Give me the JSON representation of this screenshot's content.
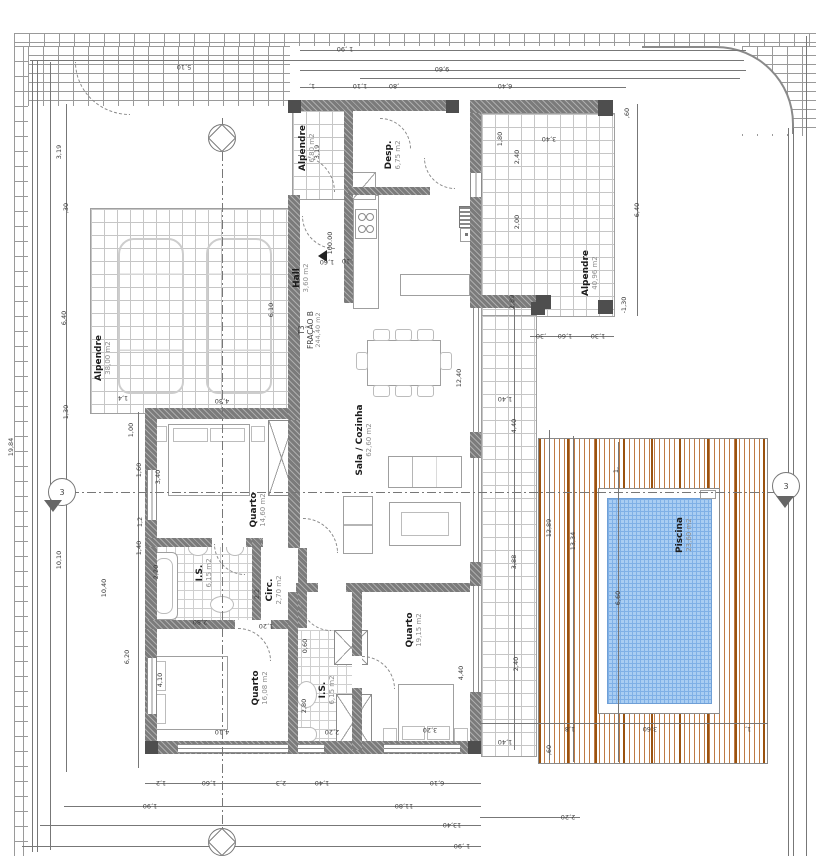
{
  "plan": {
    "fraction": {
      "line1": "T3",
      "line2": "FRAÇÃO B",
      "line3": "244,40 m2"
    },
    "level_marker": "100.00",
    "section_label": "3",
    "rooms": [
      {
        "name": "Alpendre",
        "area": "38,00 m2"
      },
      {
        "name": "Alpendre",
        "area": "6,80 m2"
      },
      {
        "name": "Hall",
        "area": "3,60 m2"
      },
      {
        "name": "Desp.",
        "area": "6,75 m2"
      },
      {
        "name": "Sala / Cozinha",
        "area": "62,60 m2"
      },
      {
        "name": "Quarto",
        "area": "14,60 m2"
      },
      {
        "name": "I.S.",
        "area": "6,15 m2"
      },
      {
        "name": "Circ.",
        "area": "2,70 m2"
      },
      {
        "name": "Quarto",
        "area": "16,08 m2"
      },
      {
        "name": "I.S.",
        "area": "6,15 m2"
      },
      {
        "name": "Quarto",
        "area": "19,15 m2"
      },
      {
        "name": "Alpendre",
        "area": "40,96 m2"
      },
      {
        "name": "Piscina",
        "area": "23,60 m2"
      }
    ],
    "dim_labels": [
      {
        "t": "1 ,90",
        "x": 345,
        "y": 49,
        "r": 180
      },
      {
        "t": "9,60",
        "x": 442,
        "y": 69,
        "r": 180
      },
      {
        "t": "5,10",
        "x": 184,
        "y": 67,
        "r": 180
      },
      {
        "t": "1,",
        "x": 312,
        "y": 86,
        "r": 180
      },
      {
        "t": "1,10",
        "x": 360,
        "y": 86,
        "r": 180
      },
      {
        "t": ",80",
        "x": 394,
        "y": 86,
        "r": 180
      },
      {
        "t": "6,40",
        "x": 505,
        "y": 86,
        "r": 180
      },
      {
        "t": ",60",
        "x": 627,
        "y": 113,
        "r": -90
      },
      {
        "t": "3,40",
        "x": 549,
        "y": 139,
        "r": 180
      },
      {
        "t": "2,40",
        "x": 517,
        "y": 157,
        "r": -90
      },
      {
        "t": "2,00",
        "x": 517,
        "y": 222,
        "r": -90
      },
      {
        "t": "6,40",
        "x": 637,
        "y": 210,
        "r": -90
      },
      {
        "t": "-1,30",
        "x": 624,
        "y": 305,
        "r": -90
      },
      {
        "t": "2,89",
        "x": 512,
        "y": 302,
        "r": -90
      },
      {
        "t": ",30",
        "x": 541,
        "y": 336,
        "r": 180
      },
      {
        "t": "1,60",
        "x": 565,
        "y": 336,
        "r": 180
      },
      {
        "t": "1,30",
        "x": 598,
        "y": 336,
        "r": 180
      },
      {
        "t": "1,40",
        "x": 505,
        "y": 399,
        "r": 180
      },
      {
        "t": "4,40",
        "x": 514,
        "y": 426,
        "r": -90
      },
      {
        "t": "3,88",
        "x": 514,
        "y": 562,
        "r": -90
      },
      {
        "t": "2,40",
        "x": 516,
        "y": 664,
        "r": -90
      },
      {
        "t": "1,40",
        "x": 505,
        "y": 742,
        "r": 180
      },
      {
        "t": "12,89",
        "x": 549,
        "y": 528,
        "r": -90
      },
      {
        "t": "13,34",
        "x": 573,
        "y": 541,
        "r": -90
      },
      {
        "t": "1,",
        "x": 616,
        "y": 470,
        "r": -90
      },
      {
        "t": "6,60",
        "x": 618,
        "y": 598,
        "r": -90
      },
      {
        "t": ",60",
        "x": 549,
        "y": 750,
        "r": -90
      },
      {
        "t": "1,8",
        "x": 570,
        "y": 729,
        "r": 180
      },
      {
        "t": "3,60",
        "x": 650,
        "y": 729,
        "r": 180
      },
      {
        "t": "1,",
        "x": 748,
        "y": 729,
        "r": 180
      },
      {
        "t": "2,20",
        "x": 568,
        "y": 817,
        "r": 180
      },
      {
        "t": "19,84",
        "x": 11,
        "y": 447,
        "r": -90
      },
      {
        "t": "3,19",
        "x": 59,
        "y": 152,
        "r": -90
      },
      {
        "t": ",30",
        "x": 66,
        "y": 208,
        "r": -90
      },
      {
        "t": "6,40",
        "x": 64,
        "y": 318,
        "r": -90
      },
      {
        "t": "1,30",
        "x": 66,
        "y": 412,
        "r": -90
      },
      {
        "t": "10,10",
        "x": 59,
        "y": 560,
        "r": -90
      },
      {
        "t": "1,00",
        "x": 131,
        "y": 430,
        "r": -90
      },
      {
        "t": "1,60",
        "x": 139,
        "y": 470,
        "r": -90
      },
      {
        "t": "1,2",
        "x": 140,
        "y": 522,
        "r": -90
      },
      {
        "t": "1,40",
        "x": 139,
        "y": 548,
        "r": -90
      },
      {
        "t": "10,40",
        "x": 104,
        "y": 588,
        "r": -90
      },
      {
        "t": "6,20",
        "x": 127,
        "y": 657,
        "r": -90
      },
      {
        "t": "6,10",
        "x": 271,
        "y": 310,
        "r": -90
      },
      {
        "t": "1,4",
        "x": 123,
        "y": 398,
        "r": 180
      },
      {
        "t": "4,30",
        "x": 222,
        "y": 401,
        "r": 180
      },
      {
        "t": "3,19",
        "x": 317,
        "y": 152,
        "r": -90
      },
      {
        "t": "1,60",
        "x": 327,
        "y": 262,
        "r": 180
      },
      {
        "t": ",10",
        "x": 347,
        "y": 261,
        "r": 180
      },
      {
        "t": "1,80",
        "x": 500,
        "y": 139,
        "r": -90
      },
      {
        "t": "12,40",
        "x": 459,
        "y": 378,
        "r": -90
      },
      {
        "t": "3,40",
        "x": 158,
        "y": 477,
        "r": -90
      },
      {
        "t": "2,80",
        "x": 200,
        "y": 622,
        "r": 180
      },
      {
        "t": "1,20",
        "x": 266,
        "y": 626,
        "r": 180
      },
      {
        "t": "2,20",
        "x": 156,
        "y": 572,
        "r": -90
      },
      {
        "t": "2,2",
        "x": 257,
        "y": 594,
        "r": -90
      },
      {
        "t": "0,60",
        "x": 305,
        "y": 646,
        "r": -90
      },
      {
        "t": "2,80",
        "x": 304,
        "y": 706,
        "r": -90
      },
      {
        "t": "4,10",
        "x": 160,
        "y": 680,
        "r": -90
      },
      {
        "t": "4,10",
        "x": 222,
        "y": 732,
        "r": 180
      },
      {
        "t": "2,20",
        "x": 332,
        "y": 732,
        "r": 180
      },
      {
        "t": "3,20",
        "x": 430,
        "y": 730,
        "r": 180
      },
      {
        "t": "4,40",
        "x": 461,
        "y": 673,
        "r": -90
      },
      {
        "t": "1,2",
        "x": 161,
        "y": 783,
        "r": 180
      },
      {
        "t": "1,60",
        "x": 209,
        "y": 783,
        "r": 180
      },
      {
        "t": "2,3",
        "x": 281,
        "y": 783,
        "r": 180
      },
      {
        "t": "1,40",
        "x": 322,
        "y": 783,
        "r": 180
      },
      {
        "t": "6,10",
        "x": 437,
        "y": 783,
        "r": 180
      },
      {
        "t": "1,90",
        "x": 150,
        "y": 806,
        "r": 180
      },
      {
        "t": "11,80",
        "x": 404,
        "y": 806,
        "r": 180
      },
      {
        "t": "13,40",
        "x": 452,
        "y": 825,
        "r": 180
      },
      {
        "t": "1 ,90",
        "x": 462,
        "y": 846,
        "r": 180
      }
    ],
    "colors": {
      "wall": "#7b7b7b",
      "column": "#4e4e4e",
      "pool_water": "#a9cdf2",
      "pool_grid": "#7fb0e6",
      "deck_stripe": "#b96a33",
      "paving_line": "#c6c6c6",
      "brick_line": "#9a9a9a",
      "dim_text": "#3c3c3c"
    }
  }
}
